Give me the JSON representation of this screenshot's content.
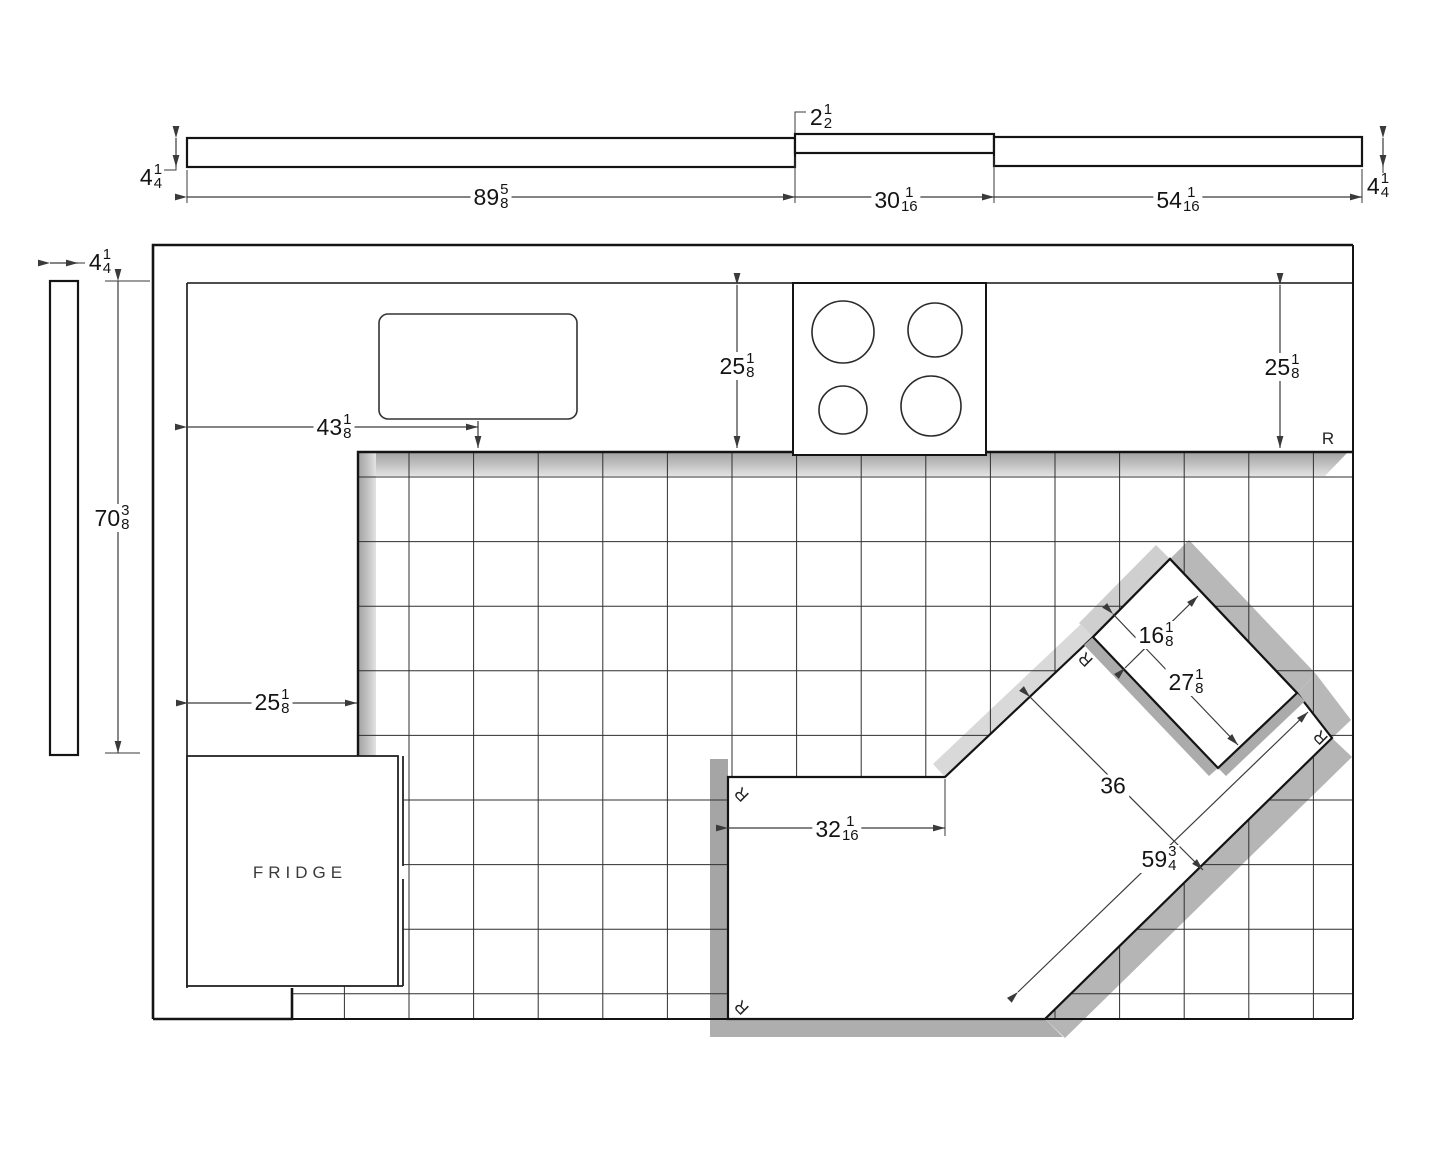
{
  "colors": {
    "line": "#141414",
    "dim_line": "#3a3a3a",
    "shadow_dark": "#a9a9a9",
    "shadow_mid": "#b8b8b8",
    "shadow_light": "#d9d9d9",
    "tile_line": "#2f2f2f"
  },
  "top_elevation": {
    "length_left": {
      "whole": "89",
      "num": "5",
      "den": "8"
    },
    "length_mid": {
      "whole": "30",
      "num": "1",
      "den": "16"
    },
    "length_right": {
      "whole": "54",
      "num": "1",
      "den": "16"
    },
    "thickness_left": {
      "whole": "4",
      "num": "1",
      "den": "4"
    },
    "thickness_right": {
      "whole": "4",
      "num": "1",
      "den": "4"
    },
    "step": {
      "whole": "2",
      "num": "1",
      "den": "2"
    }
  },
  "side_elevation": {
    "width": {
      "whole": "4",
      "num": "1",
      "den": "4"
    }
  },
  "plan": {
    "run_height": {
      "whole": "70",
      "num": "3",
      "den": "8"
    },
    "sink_offset": {
      "whole": "43",
      "num": "1",
      "den": "8"
    },
    "counter_depth_mid": {
      "whole": "25",
      "num": "1",
      "den": "8"
    },
    "counter_depth_right": {
      "whole": "25",
      "num": "1",
      "den": "8"
    },
    "left_counter_width": {
      "whole": "25",
      "num": "1",
      "den": "8"
    },
    "peninsula_length": {
      "whole": "32",
      "num": "1",
      "den": "16"
    },
    "island_width": {
      "whole": "36"
    },
    "island_length": {
      "whole": "59",
      "num": "3",
      "den": "4"
    },
    "bar_width": {
      "whole": "16",
      "num": "1",
      "den": "8"
    },
    "bar_length": {
      "whole": "27",
      "num": "1",
      "den": "8"
    },
    "fridge_label": "FRIDGE",
    "r_label": "R"
  }
}
